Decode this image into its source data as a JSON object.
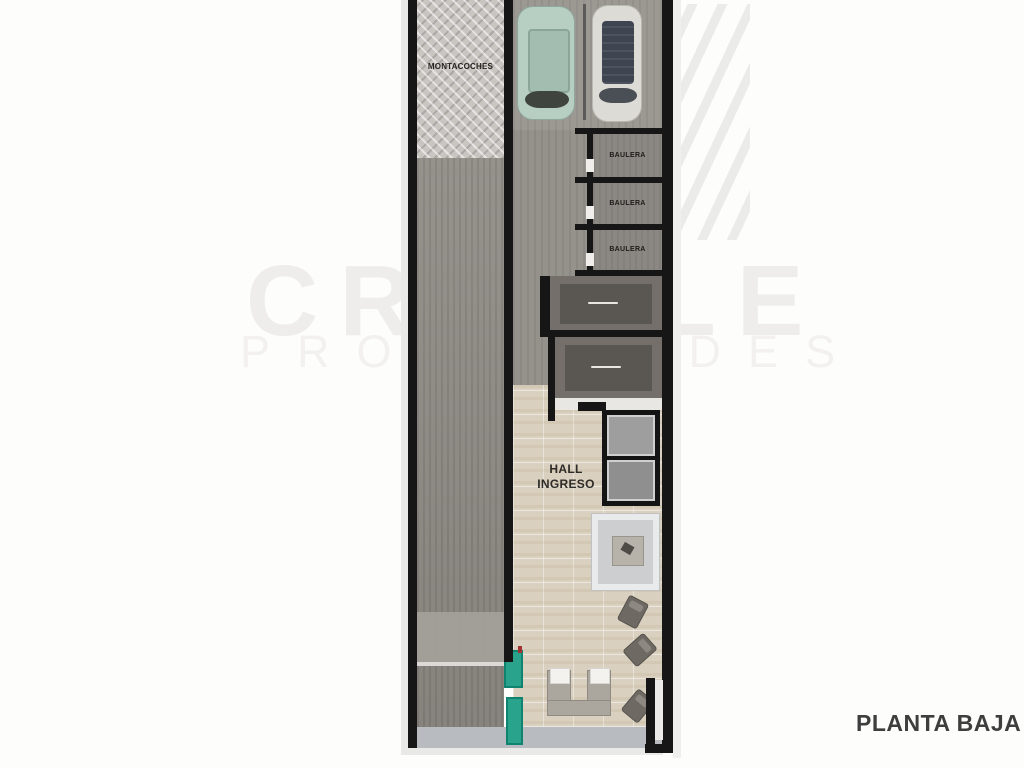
{
  "watermark": {
    "line1": "CRIVALE",
    "line2": "PROPIEDADES",
    "motif": "diagonal-stripes-logo",
    "color": "#eeedeb"
  },
  "plan": {
    "caption": "PLANTA BAJA",
    "montacoches_label": "MONTACOCHES",
    "bauleras": [
      "BAULERA",
      "BAULERA",
      "BAULERA"
    ],
    "hall_line1": "HALL",
    "hall_line2": "INGRESO",
    "objects": {
      "car_left": "green-car-top-view",
      "car_right": "white-car-top-view",
      "elevator": "elevator-shaft",
      "rug": "rug-with-side-table",
      "sofa": "u-shaped-sofa-with-cushions",
      "chairs": "three-armchairs",
      "planters": "teal-planters"
    },
    "colors": {
      "wall": "#161616",
      "hatch_area": "#c9c6c2",
      "garage_floor": "#8f8b85",
      "parking_floor": "#9c9892",
      "storage_floor": "#8b8782",
      "dark_room": "#746f6a",
      "hall_floor": "#d9d0bf",
      "sidewalk": "#b8bbc0",
      "planter": "#2aa38c",
      "car_green": "#b7cec3",
      "car_white": "#dcdbd6",
      "caption_text": "#3e3e3e"
    }
  }
}
